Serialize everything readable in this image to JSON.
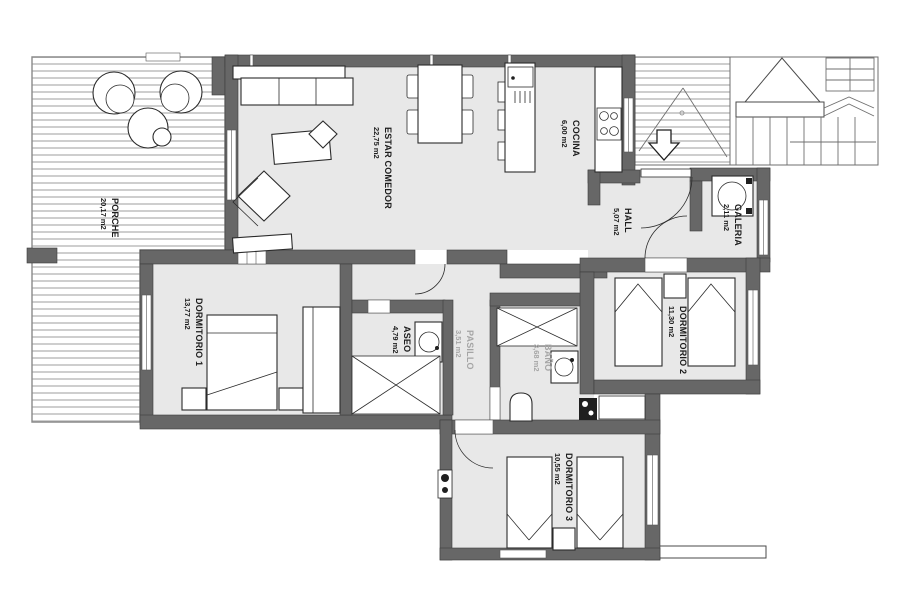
{
  "plan": {
    "rooms": [
      {
        "name": "PORCHE",
        "area": "20,17 m2"
      },
      {
        "name": "ESTAR COMEDOR",
        "area": "22,75 m2"
      },
      {
        "name": "COCINA",
        "area": "6,00 m2"
      },
      {
        "name": "HALL",
        "area": "5,07 m2"
      },
      {
        "name": "GALERIA",
        "area": "2,11 m2"
      },
      {
        "name": "DORMITORIO 1",
        "area": "13,77 m2"
      },
      {
        "name": "DORMITORIO 2",
        "area": "11,30 m2"
      },
      {
        "name": "DORMITORIO 3",
        "area": "10,55 m2"
      },
      {
        "name": "ASEO",
        "area": "4,79 m2"
      },
      {
        "name": "PASILLO",
        "area": "3,51 m2"
      },
      {
        "name": "BAÑO",
        "area": "3,68 m2"
      }
    ],
    "colors": {
      "wall": "#676767",
      "floor": "#e8e8e8",
      "label": "#1c1c1c",
      "muted_label": "#a5a5a5",
      "deck_stripe": "#b9b9b9",
      "background": "#ffffff"
    }
  }
}
